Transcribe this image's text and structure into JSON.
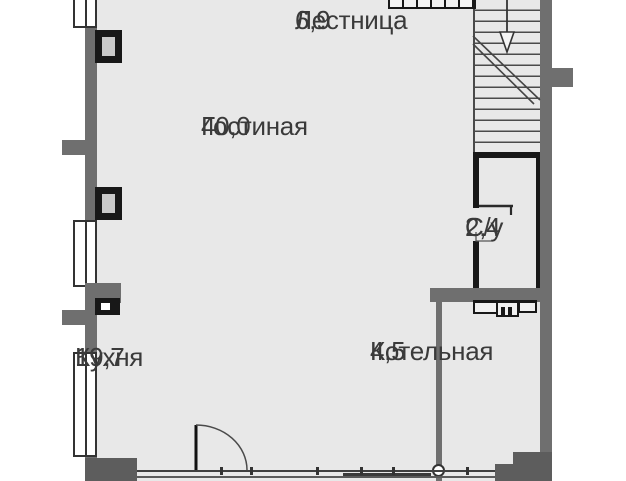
{
  "plan": {
    "rooms": [
      {
        "id": "lestnitsa",
        "name": "Лестница",
        "area": "6,9"
      },
      {
        "id": "gostinaya",
        "name": "Гостиная",
        "area": "40,0"
      },
      {
        "id": "su",
        "name": "С/у",
        "area": "2,4"
      },
      {
        "id": "kuhnya",
        "name": "Кухня",
        "area": "19,7"
      },
      {
        "id": "kotelnaya",
        "name": "Котельная",
        "area": "4,5"
      }
    ],
    "colors": {
      "outside": "#ffffff",
      "floor": "#e8e8e8",
      "wall": "#6f6f6f",
      "wall_dark": "#5d5d5d",
      "black": "#181818",
      "line": "#3f3f3f",
      "text": "#3a3a3a"
    }
  }
}
